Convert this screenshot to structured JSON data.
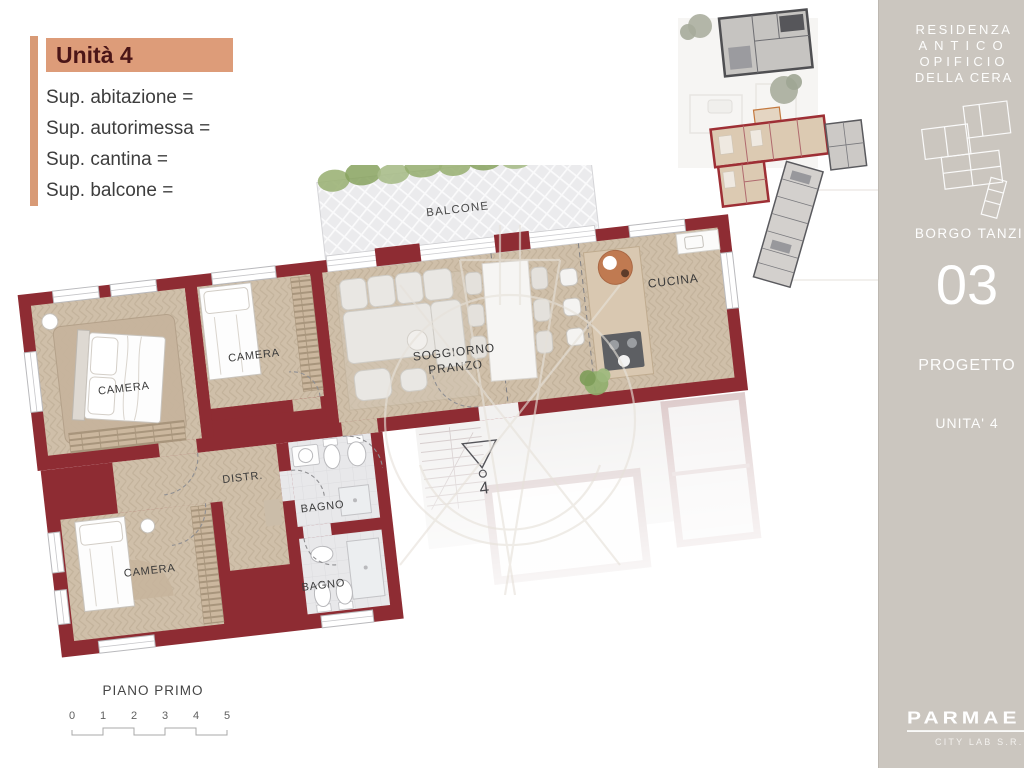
{
  "panel": {
    "title": "Unità 4",
    "sup": [
      "Sup. abitazione =",
      "Sup. autorimessa =",
      "Sup. cantina =",
      "Sup. balcone ="
    ]
  },
  "plan": {
    "labels": {
      "balcone": "BALCONE",
      "camera1": "CAMERA",
      "camera2": "CAMERA",
      "soggiorno_line1": "SOGGIORNO",
      "soggiorno_line2": "PRANZO",
      "cucina": "CUCINA",
      "distr": "DISTR.",
      "bagno1": "BAGNO",
      "bagno2": "BAGNO",
      "camera3": "CAMERA",
      "unit_marker": "4",
      "floor": "PIANO PRIMO"
    },
    "scale": [
      "0",
      "1",
      "2",
      "3",
      "4",
      "5"
    ]
  },
  "sidebar": {
    "residence": [
      "RESIDENZA",
      "ANTICO",
      "OPIFICIO",
      "DELLA CERA"
    ],
    "location": "BORGO TANZI",
    "number": "03",
    "section": "PROGETTO",
    "unit": "UNITA' 4",
    "logo": "PARMAE",
    "logo_sub": "CITY LAB S.R.L."
  },
  "colors": {
    "wall_red": "#8e2c33",
    "accent_salmon": "#dd9c79",
    "sidebar_bg": "#cbc6bf",
    "parquet": "#cfbfa9",
    "bath_tile": "#e8e8ea",
    "shrub_green": "#9cb377"
  }
}
